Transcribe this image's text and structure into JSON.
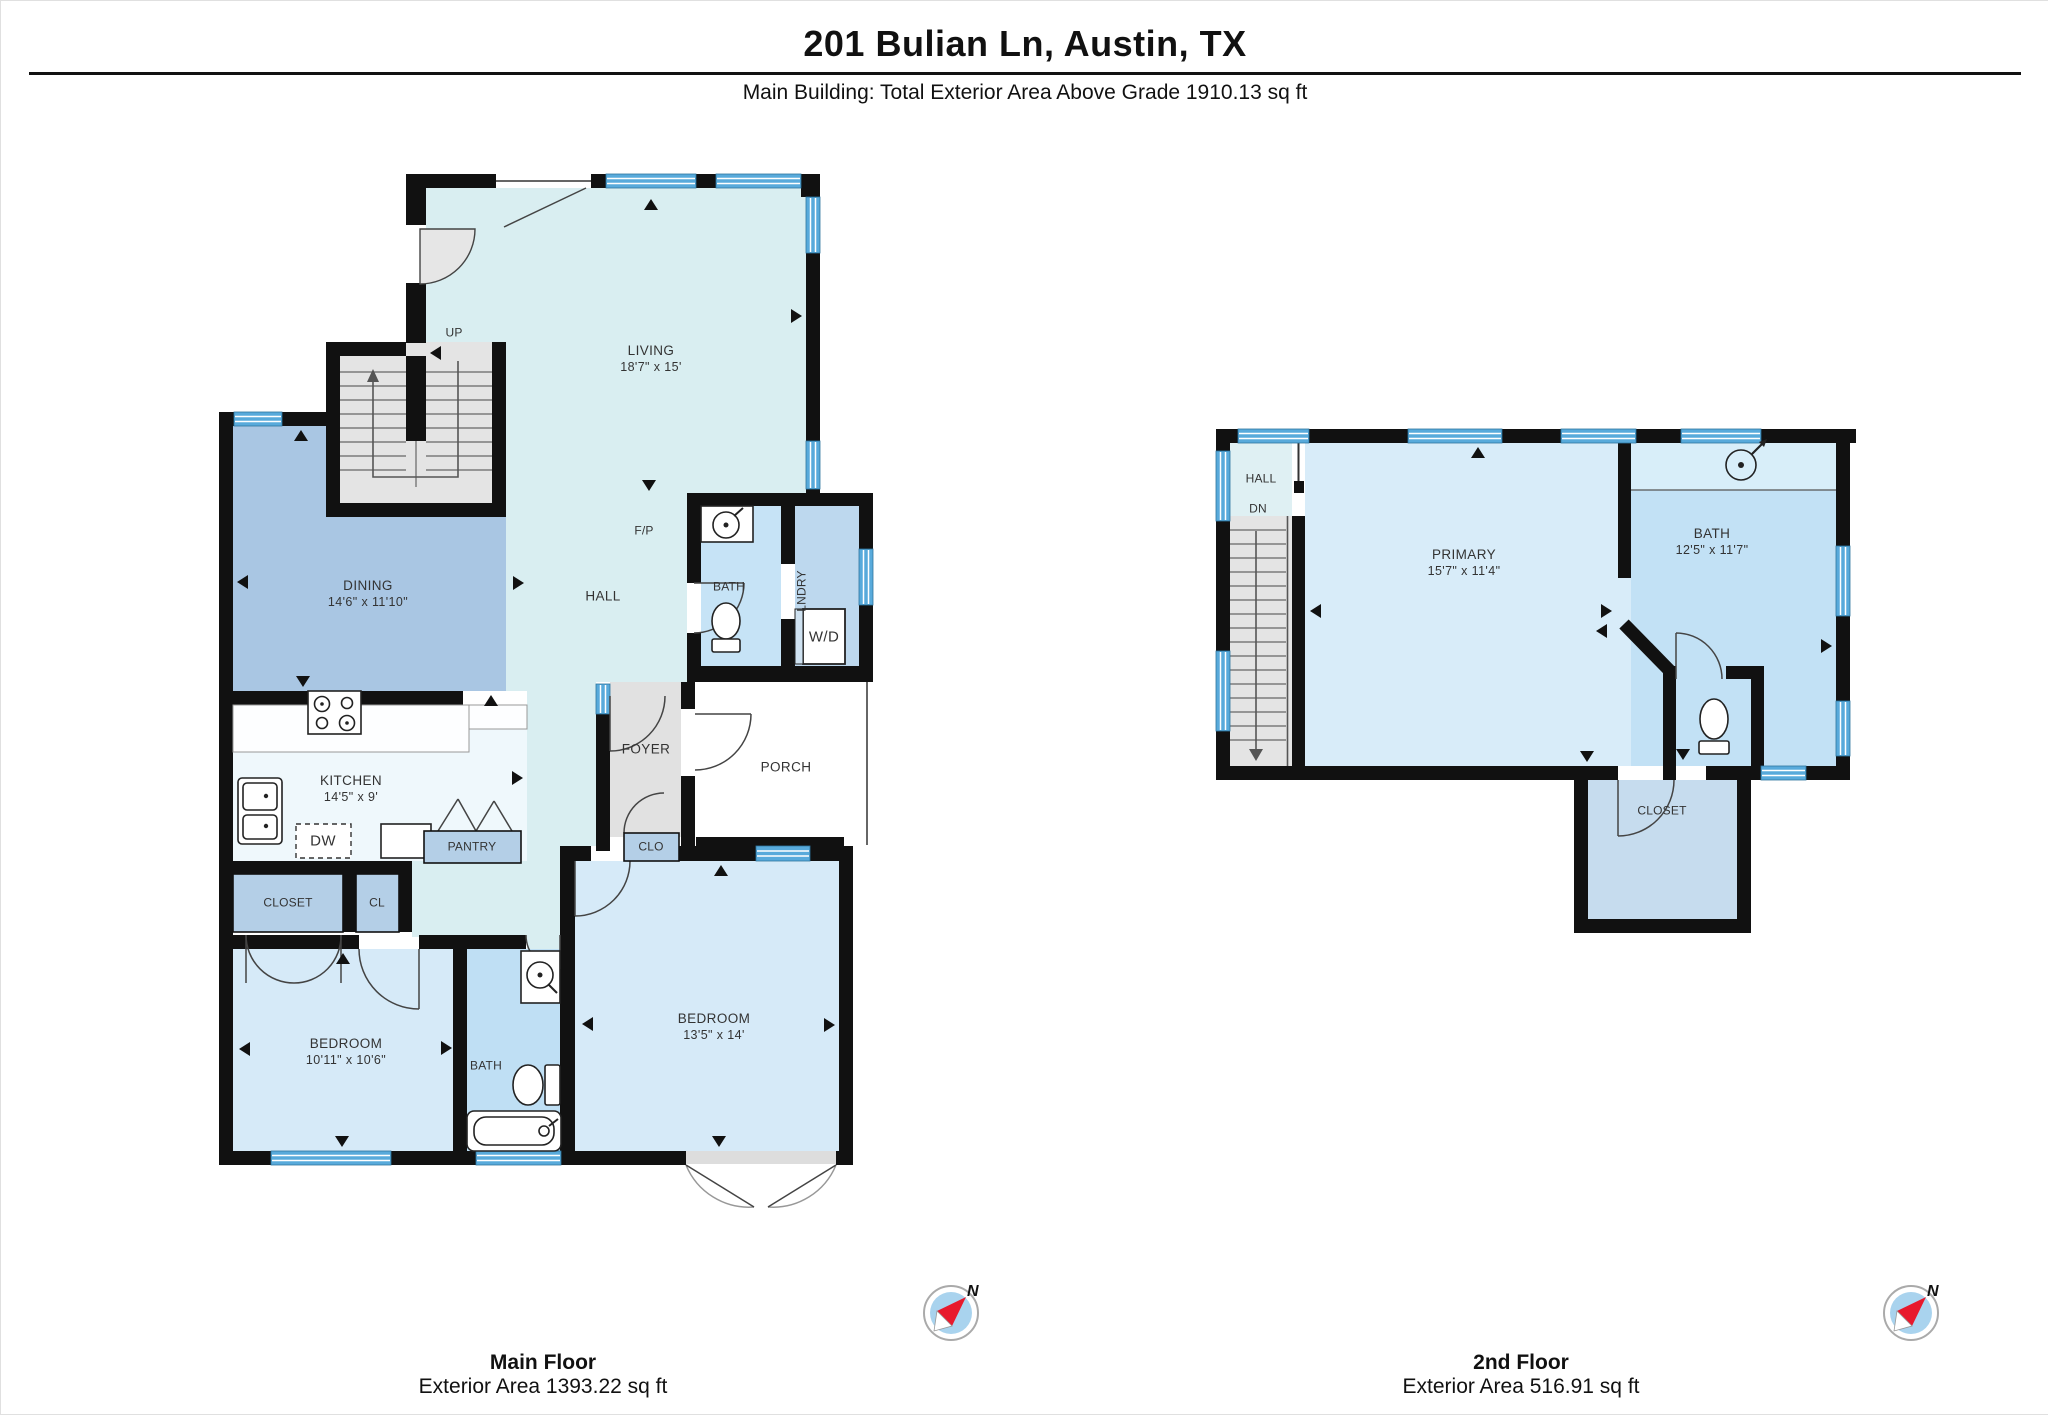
{
  "header": {
    "title": "201 Bulian Ln, Austin, TX",
    "subtitle": "Main Building: Total Exterior Area Above Grade 1910.13 sq ft"
  },
  "main_floor": {
    "caption": "Main Floor",
    "area": "Exterior Area 1393.22 sq ft",
    "rooms": {
      "living": {
        "name": "LIVING",
        "dims": "18'7\" x 15'"
      },
      "dining": {
        "name": "DINING",
        "dims": "14'6\" x 11'10\""
      },
      "kitchen": {
        "name": "KITCHEN",
        "dims": "14'5\" x 9'"
      },
      "hall": {
        "name": "HALL"
      },
      "foyer": {
        "name": "FOYER"
      },
      "porch": {
        "name": "PORCH"
      },
      "bath": {
        "name": "BATH"
      },
      "laundry": {
        "name": "LNDRY"
      },
      "pantry": {
        "name": "PANTRY"
      },
      "closet": {
        "name": "CLOSET"
      },
      "cl": {
        "name": "CL"
      },
      "clo": {
        "name": "CLO"
      },
      "bedroom1": {
        "name": "BEDROOM",
        "dims": "10'11\" x 10'6\""
      },
      "bedroom2": {
        "name": "BEDROOM",
        "dims": "13'5\" x 14'"
      },
      "bath2": {
        "name": "BATH"
      }
    },
    "annotations": {
      "up": "UP",
      "fireplace": "F/P",
      "washer_dryer": "W/D",
      "dishwasher": "DW"
    }
  },
  "second_floor": {
    "caption": "2nd Floor",
    "area": "Exterior Area 516.91 sq ft",
    "rooms": {
      "hall": {
        "name": "HALL"
      },
      "primary": {
        "name": "PRIMARY",
        "dims": "15'7\" x 11'4\""
      },
      "bath": {
        "name": "BATH",
        "dims": "12'5\" x 11'7\""
      },
      "closet": {
        "name": "CLOSET"
      }
    },
    "annotations": {
      "down": "DN"
    }
  },
  "compass": {
    "north_label": "N"
  },
  "colors": {
    "wall": "#111111",
    "window_blue": "#58aadb",
    "living_hall": "#d9eef1",
    "dining": "#a9c6e3",
    "kitchen": "#eff8fc",
    "bedroom": "#d6eaf8",
    "bath": "#c2e1f5",
    "laundry": "#bdd8ee",
    "closet_box": "#b4cfe7",
    "stairs": "#e4e4e4",
    "foyer": "#e1e1e1",
    "porch": "#ffffff",
    "compass_red": "#e8192c"
  }
}
